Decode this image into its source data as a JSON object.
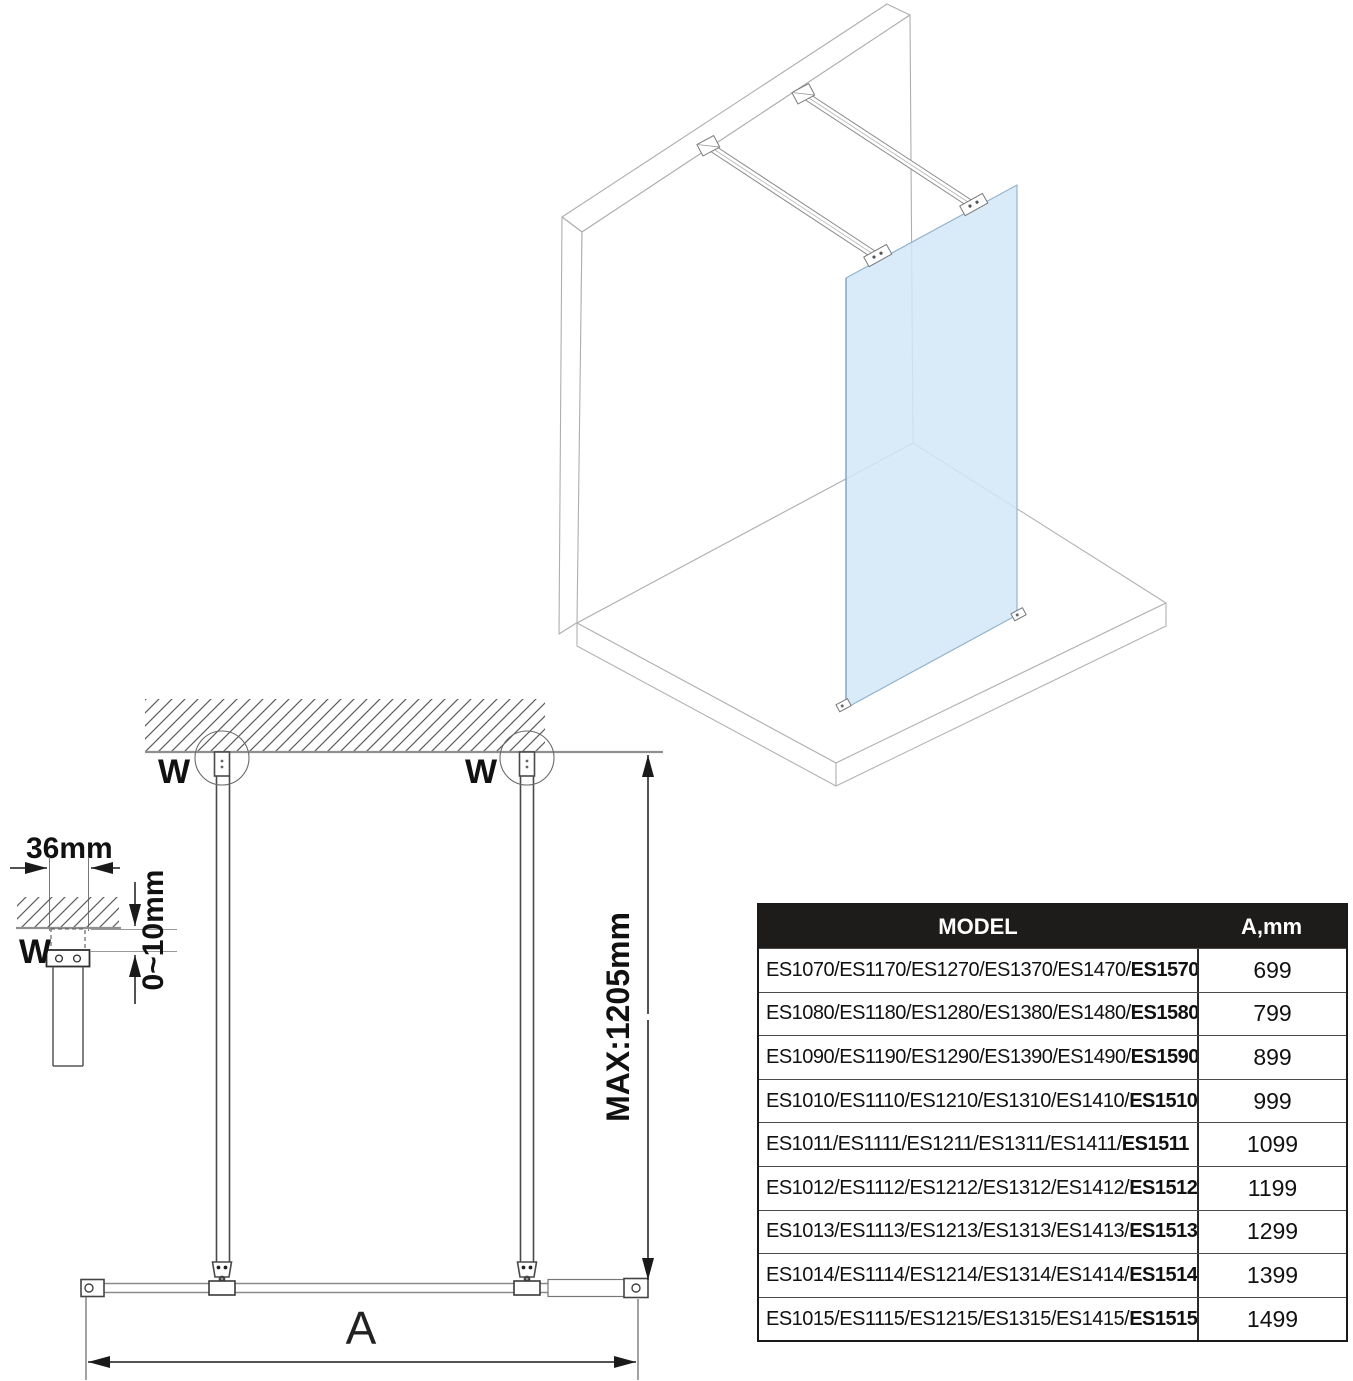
{
  "colors": {
    "glass_fill": "#d2e7f8",
    "glass_edge": "#93b3cb",
    "structure_line": "#9f9f9f",
    "dimension_line": "#1a1a1a",
    "table_header_bg": "#1d1c1b",
    "table_header_text": "#ffffff"
  },
  "plan_view": {
    "wall_anchor_label_left": "W",
    "wall_anchor_label_right": "W",
    "max_dimension": "MAX:1205mm",
    "width_dimension": "A"
  },
  "detail_view": {
    "label": "W",
    "width_dimension": "36mm",
    "gap_dimension": "0~10mm"
  },
  "table": {
    "header": {
      "model": "MODEL",
      "a": "A,mm"
    },
    "rows": [
      {
        "model_prefix": "ES1070/ES1170/ES1270/ES1370/ES1470/",
        "model_last": "ES1570",
        "a_mm": "699"
      },
      {
        "model_prefix": "ES1080/ES1180/ES1280/ES1380/ES1480/",
        "model_last": "ES1580",
        "a_mm": "799"
      },
      {
        "model_prefix": "ES1090/ES1190/ES1290/ES1390/ES1490/",
        "model_last": "ES1590",
        "a_mm": "899"
      },
      {
        "model_prefix": "ES1010/ES1110/ES1210/ES1310/ES1410/",
        "model_last": "ES1510",
        "a_mm": "999"
      },
      {
        "model_prefix": "ES1011/ES1111/ES1211/ES1311/ES1411/",
        "model_last": "ES1511",
        "a_mm": "1099"
      },
      {
        "model_prefix": "ES1012/ES1112/ES1212/ES1312/ES1412/",
        "model_last": "ES1512",
        "a_mm": "1199"
      },
      {
        "model_prefix": "ES1013/ES1113/ES1213/ES1313/ES1413/",
        "model_last": "ES1513",
        "a_mm": "1299"
      },
      {
        "model_prefix": "ES1014/ES1114/ES1214/ES1314/ES1414/",
        "model_last": "ES1514",
        "a_mm": "1399"
      },
      {
        "model_prefix": "ES1015/ES1115/ES1215/ES1315/ES1415/",
        "model_last": "ES1515",
        "a_mm": "1499"
      }
    ]
  }
}
